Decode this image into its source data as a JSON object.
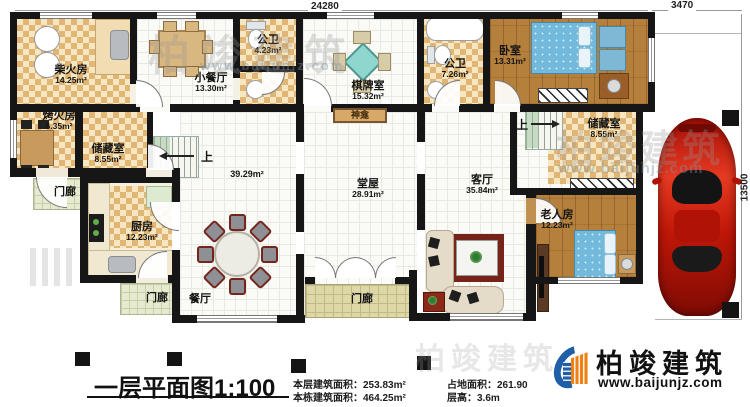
{
  "dims": {
    "top": "24280",
    "top_right": "3470",
    "right": "13500"
  },
  "rooms": {
    "chaihuofang": {
      "name": "柴火房",
      "area": "14.25m²"
    },
    "xiaocanting": {
      "name": "小餐厅",
      "area": "13.30m²"
    },
    "gongwei_small": {
      "name": "公卫",
      "area": "4.23m²"
    },
    "qipaishi": {
      "name": "棋牌室",
      "area": "15.32m²"
    },
    "gongwei_big": {
      "name": "公卫",
      "area": "7.26m²"
    },
    "woshi": {
      "name": "卧室",
      "area": "13.31m²"
    },
    "kaohuofang": {
      "name": "烤火房",
      "area": "6.35m²"
    },
    "chucang_left": {
      "name": "储藏室",
      "area": "8.55m²"
    },
    "chucang_right": {
      "name": "储藏室",
      "area": "8.55m²"
    },
    "hall_area": {
      "area": "39.29m²"
    },
    "tangwu": {
      "name": "堂屋",
      "area": "28.91m²"
    },
    "keting": {
      "name": "客厅",
      "area": "35.84m²"
    },
    "laorenfang": {
      "name": "老人房",
      "area": "12.23m²"
    },
    "chufang": {
      "name": "厨房",
      "area": "12.23m²"
    },
    "canting": {
      "name": "餐厅"
    }
  },
  "labels": {
    "porch": "门廊",
    "up": "上",
    "shrine": "神龛"
  },
  "title": {
    "text": "一层平面图",
    "scale": "1:100"
  },
  "stats": {
    "floor_area_label": "本层建筑面积：",
    "floor_area": "253.83m²",
    "total_area_label": "本栋建筑面积：",
    "total_area": "464.25m²",
    "land_area_label": "占地面积：",
    "land_area": "261.90",
    "height_label": "层高：",
    "height": "3.6m"
  },
  "brand": {
    "name": "柏竣建筑",
    "url": "www.baijunjz.com"
  }
}
